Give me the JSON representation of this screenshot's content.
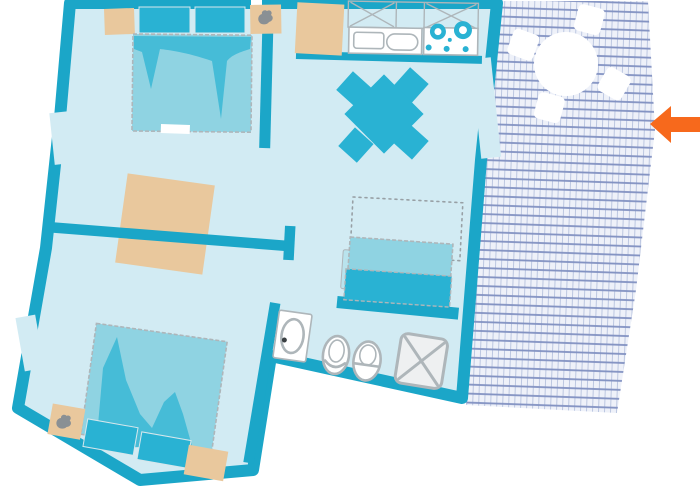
{
  "meta": {
    "title": "Apartment floor plan with terrace",
    "type": "floor-plan",
    "visible_text": "none"
  },
  "labels": {
    "apartment": "Apartment floor plan",
    "bedroom1": "Bedroom 1 (top left) with double bed and nightstands",
    "bedroom2": "Bedroom 2 (bottom left) with double bed and nightstands",
    "kitchen": "Kitchen and living room with dining table and daybed sofa",
    "bathroom": "Bathroom with washbasin, toilet, bidet and shower",
    "terrace": "Terrace with round table and four chairs",
    "arrow": "Orange arrow pointing left toward the terrace"
  },
  "rooms": [
    {
      "id": "bedroom-1",
      "furniture": [
        "double-bed",
        "pillow",
        "pillow",
        "nightstand",
        "nightstand-with-plant"
      ]
    },
    {
      "id": "kitchen-living-room",
      "furniture": [
        "kitchen-counter",
        "upper-cabinets",
        "double-sink",
        "stove-with-burners",
        "dining-table",
        "dining-chair",
        "dining-chair",
        "dining-chair",
        "dining-chair",
        "daybed-sofa",
        "fold-out-bed-dashed-outline"
      ]
    },
    {
      "id": "bathroom",
      "furniture": [
        "washbasin",
        "toilet",
        "bidet",
        "shower"
      ]
    },
    {
      "id": "bedroom-2",
      "furniture": [
        "double-bed",
        "pillow",
        "pillow",
        "nightstand-with-plant",
        "nightstand"
      ]
    },
    {
      "id": "terrace",
      "furniture": [
        "round-table",
        "terrace-chair",
        "terrace-chair",
        "terrace-chair",
        "terrace-chair"
      ]
    }
  ],
  "annotations": {
    "arrow": {
      "direction": "left",
      "color": "#f7691c"
    }
  },
  "colors": {
    "wall": "#1ba6c8",
    "floor": "#d2ebf3",
    "accent": "#29b2d3",
    "bed": "#8fd3e2",
    "drape": "#46bcd7",
    "armrest": "#b9e3ed",
    "wood": "#e9c89d",
    "outline": "#aeb6ba",
    "shower": "#eef0f1",
    "dash": "#98a0a5",
    "glyph": "#8a9094",
    "terrace_bg": "#eef1f9",
    "terrace_major": "#8292c2",
    "terrace_minor": "#bcc7e1",
    "arrow": "#f7691c"
  }
}
